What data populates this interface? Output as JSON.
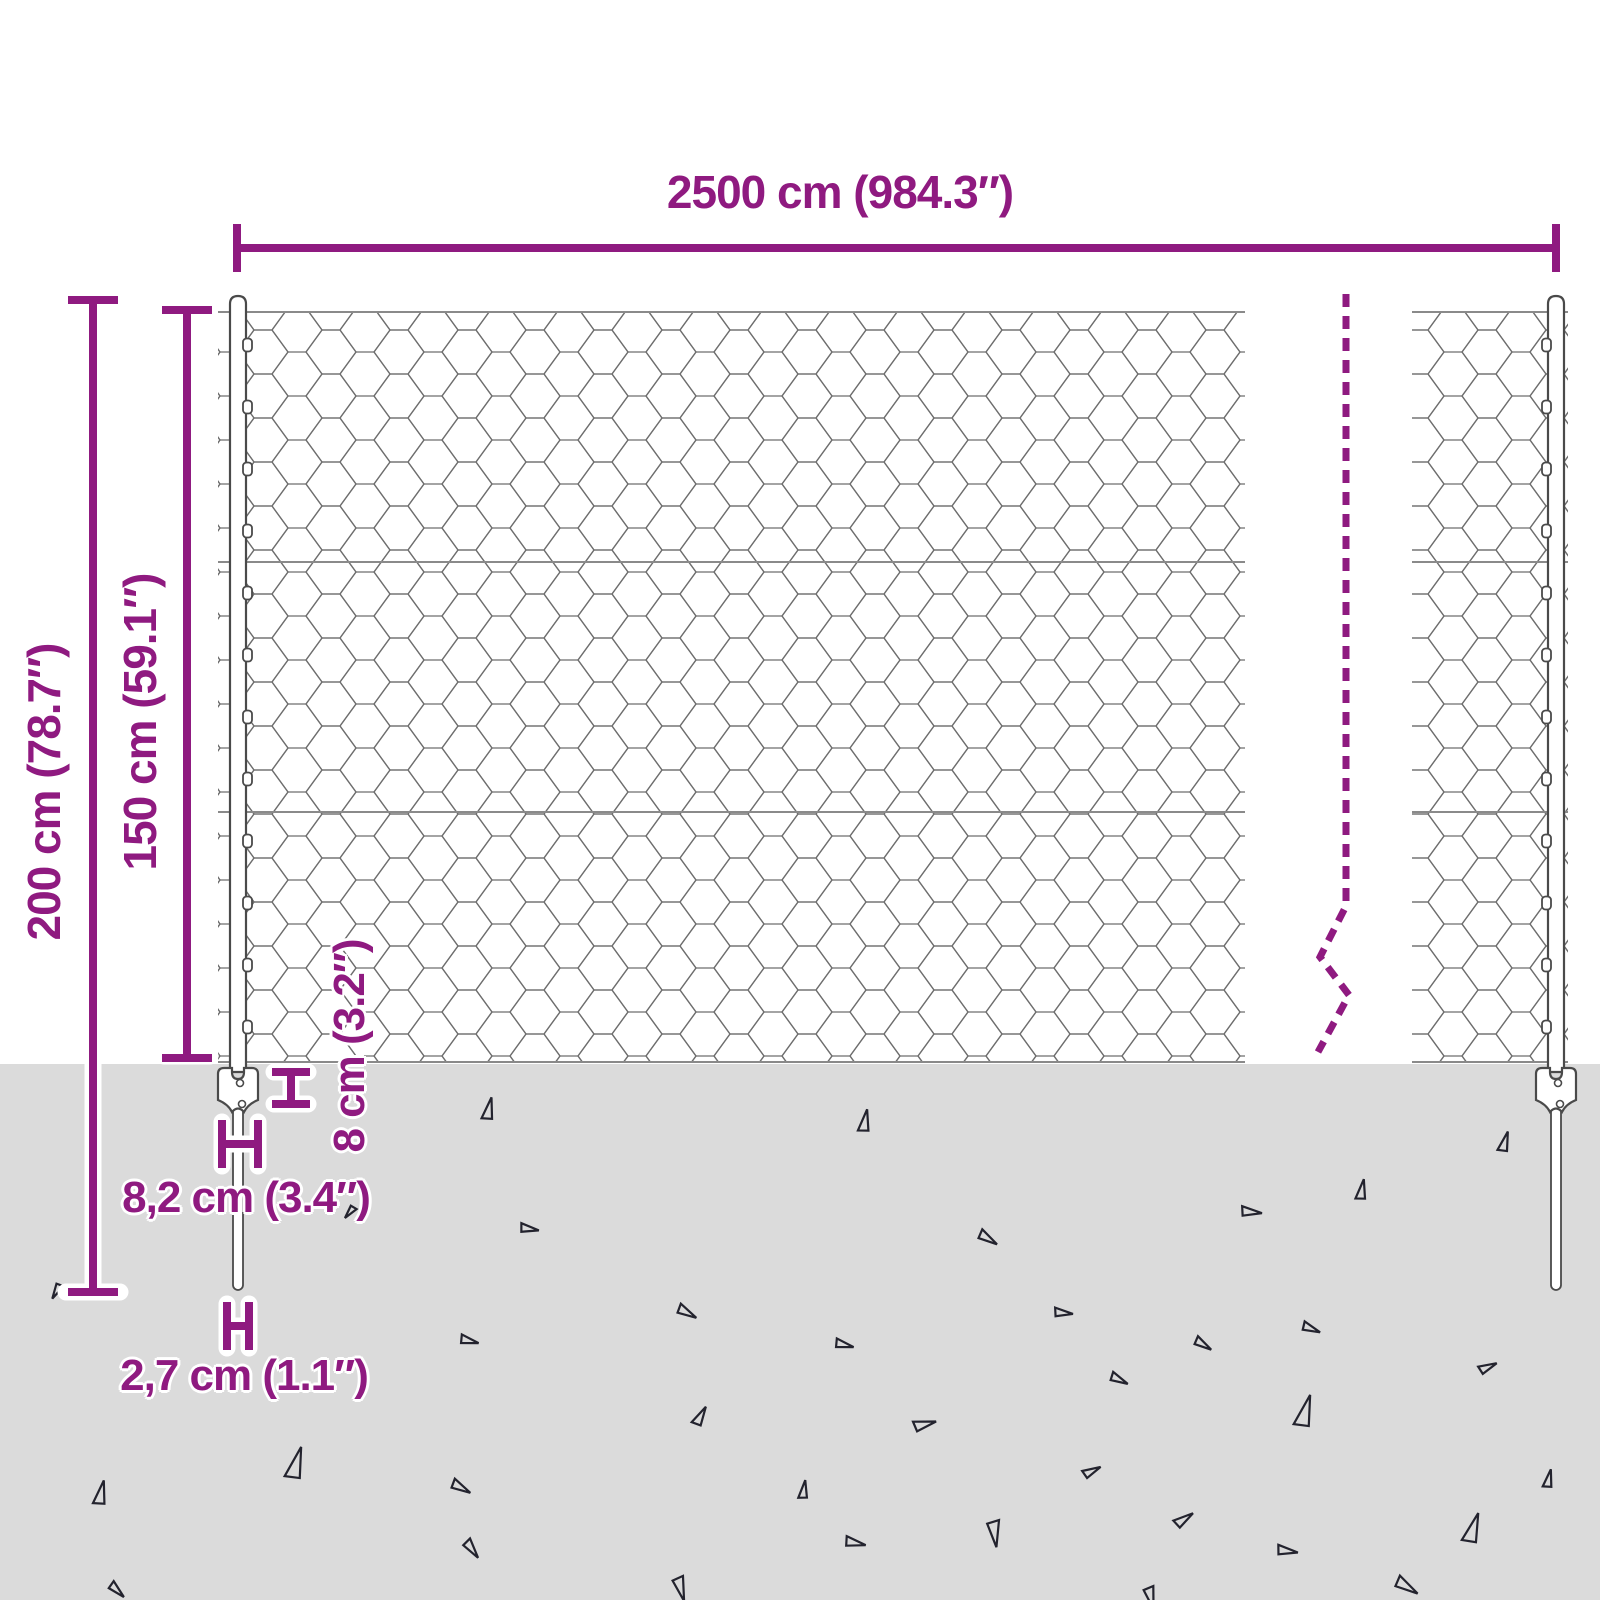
{
  "labels": {
    "total_width": "2500 cm (984.3″)",
    "post_total_height": "200 cm (78.7″)",
    "mesh_height": "150 cm (59.1″)",
    "anchor_plate_height": "8 cm (3.2″)",
    "anchor_plate_width": "8,2 cm (3.4″)",
    "post_diameter": "2,7 cm (1.1″)"
  },
  "colors": {
    "accent_purple": "#8f1a80",
    "ground_gray": "#dbdbdb",
    "wire_gray": "#6e6e6e",
    "triangle_outline": "#23232e",
    "background": "#ffffff"
  },
  "ground": {
    "triangles": [
      [
        57,
        1292,
        8,
        205
      ],
      [
        488,
        1108,
        11,
        8
      ],
      [
        350,
        1213,
        7,
        215
      ],
      [
        530,
        1228,
        9,
        95
      ],
      [
        688,
        1312,
        10,
        115
      ],
      [
        470,
        1340,
        9,
        100
      ],
      [
        700,
        1415,
        10,
        25
      ],
      [
        295,
        1462,
        16,
        12
      ],
      [
        100,
        1492,
        12,
        8
      ],
      [
        462,
        1487,
        10,
        115
      ],
      [
        473,
        1549,
        10,
        140
      ],
      [
        118,
        1590,
        9,
        130
      ],
      [
        682,
        1589,
        12,
        160
      ],
      [
        864,
        1120,
        11,
        6
      ],
      [
        1504,
        1141,
        10,
        12
      ],
      [
        1361,
        1189,
        10,
        6
      ],
      [
        1252,
        1211,
        10,
        92
      ],
      [
        989,
        1238,
        10,
        118
      ],
      [
        1064,
        1312,
        9,
        92
      ],
      [
        1312,
        1328,
        9,
        108
      ],
      [
        1204,
        1344,
        9,
        118
      ],
      [
        845,
        1344,
        9,
        100
      ],
      [
        1488,
        1366,
        9,
        62
      ],
      [
        1120,
        1379,
        9,
        112
      ],
      [
        1304,
        1410,
        16,
        12
      ],
      [
        925,
        1423,
        11,
        72
      ],
      [
        1092,
        1470,
        9,
        60
      ],
      [
        803,
        1489,
        9,
        4
      ],
      [
        1548,
        1478,
        9,
        8
      ],
      [
        1184,
        1518,
        10,
        52
      ],
      [
        996,
        1534,
        13,
        168
      ],
      [
        1472,
        1527,
        15,
        14
      ],
      [
        856,
        1542,
        10,
        98
      ],
      [
        1288,
        1550,
        10,
        94
      ],
      [
        1408,
        1586,
        12,
        118
      ],
      [
        1152,
        1598,
        11,
        162
      ]
    ]
  },
  "fence": {
    "clip_ys": [
      345,
      407,
      469,
      531,
      593,
      655,
      717,
      779,
      841,
      903,
      965,
      1027
    ]
  }
}
